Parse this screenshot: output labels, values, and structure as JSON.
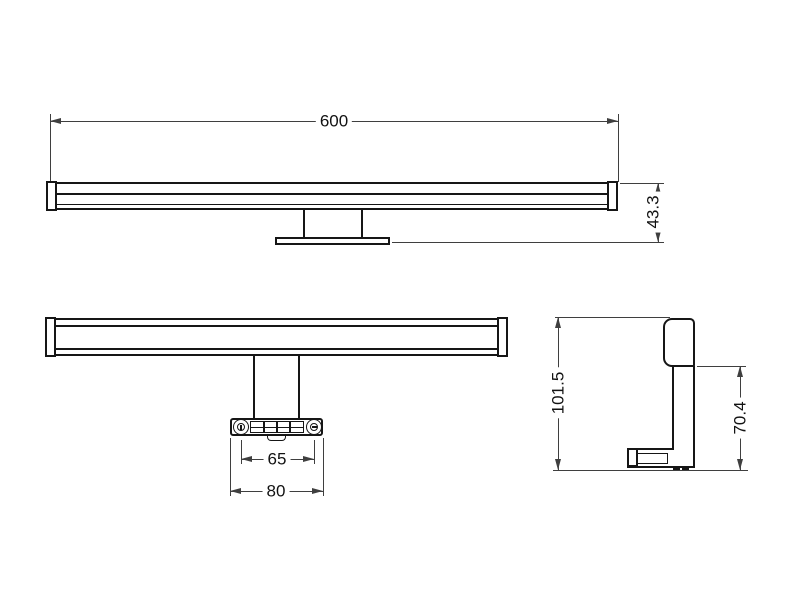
{
  "title": "Wall lamp dimensional drawing",
  "views": {
    "front": {
      "width_mm": "600",
      "depth_mm": "43.3"
    },
    "bottom": {
      "hole_spacing_mm": "65",
      "bracket_width_mm": "80"
    },
    "side": {
      "total_height_mm": "101.5",
      "bracket_height_mm": "70.4"
    }
  },
  "colors": {
    "background": "#ffffff",
    "object_line": "#161616",
    "dimension_line": "#3f3f3f"
  }
}
